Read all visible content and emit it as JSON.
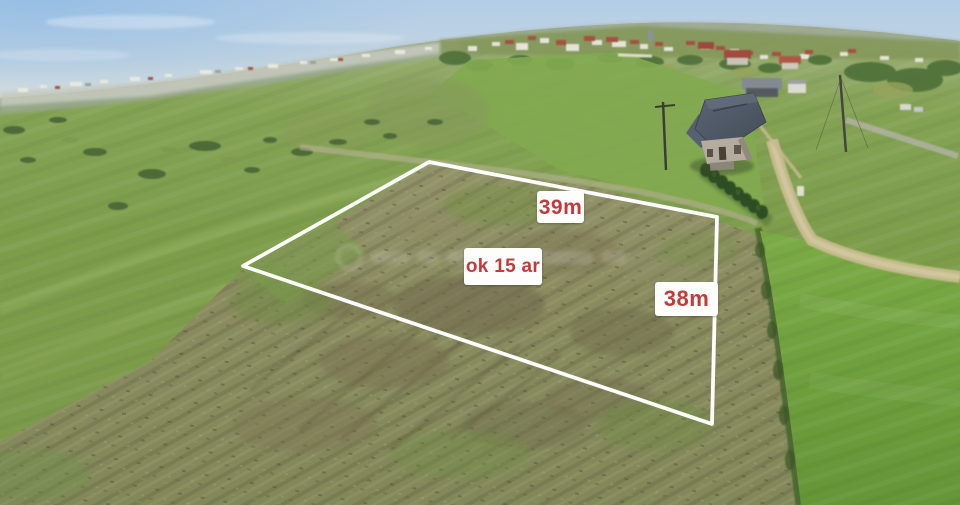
{
  "image": {
    "description": "Drone aerial photo of a grassy building plot for sale, marked with a white boundary overlay and red dimension labels"
  },
  "plot": {
    "outline_points": "243,266 429,162 717,217 712,424",
    "outline_color": "#ffffff",
    "labels": {
      "top_width": "39m",
      "right_depth": "38m",
      "area": "ok 15 ar"
    },
    "label_style": {
      "text_color": "#c23a3a",
      "background": "#ffffff"
    }
  },
  "scene_colors": {
    "sky": "#c3d4e0",
    "far_town": "#c6cabf",
    "meadow_green": "#7d9d4b",
    "plot_field": "#8a8c60",
    "right_meadow": "#6d9d3c",
    "dirt_road": "#c9bc92",
    "house_roof": "#4e5664",
    "conifer_hedge": "#2c4a24"
  },
  "watermark": {
    "present": true,
    "legible": false
  }
}
